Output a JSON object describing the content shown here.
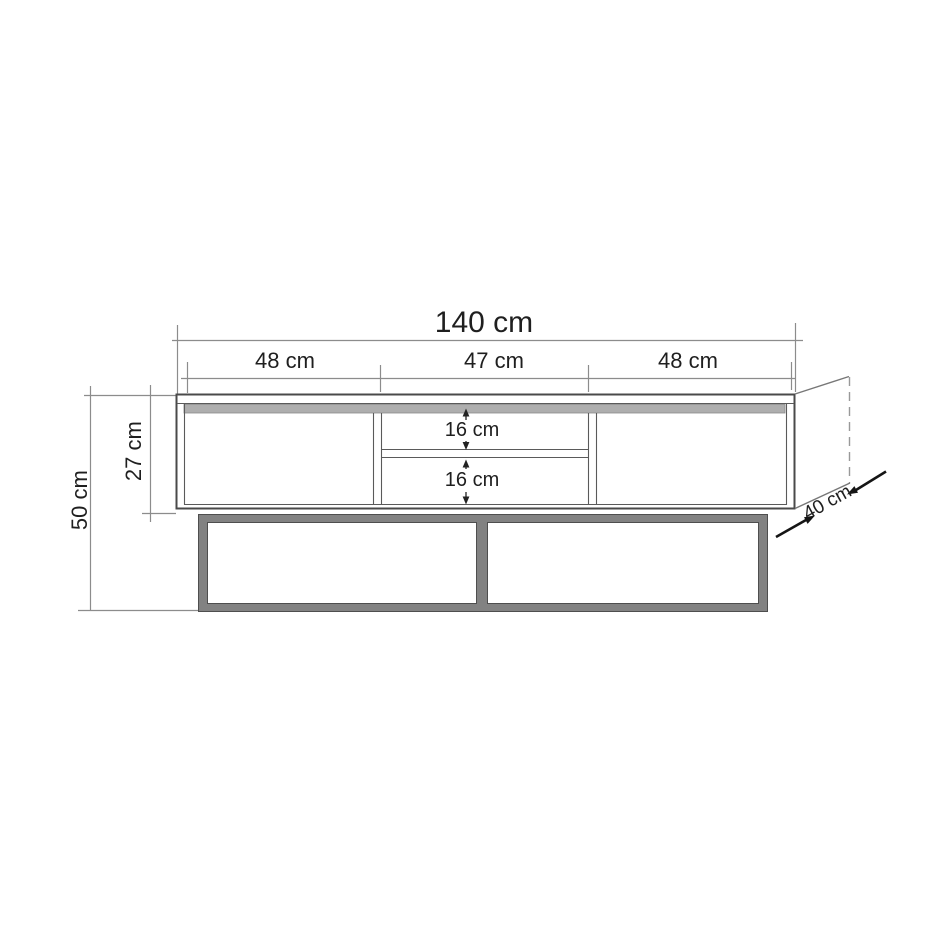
{
  "drawing": {
    "labels": {
      "total_width": "140 cm",
      "section_left": "48 cm",
      "section_center": "47 cm",
      "section_right": "48 cm",
      "overall_height": "50 cm",
      "body_height": "27 cm",
      "niche_upper": "16 cm",
      "niche_lower": "16 cm",
      "depth": "40 cm"
    }
  },
  "colors": {
    "background": "#ffffff",
    "outline": "#4a4a4a",
    "dimension_line": "#8c8c8c",
    "label_text": "#1f1f1f",
    "top_strip_gray": "#aeaeae",
    "base_frame_gray": "#828282"
  }
}
